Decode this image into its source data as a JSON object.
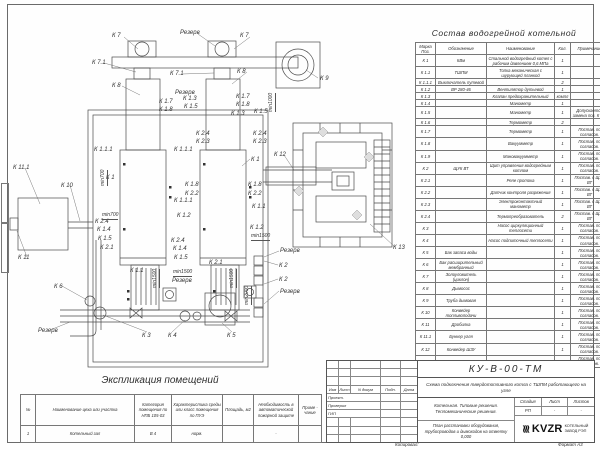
{
  "spec_table": {
    "title": "Состав водогрейной котельной",
    "headers": [
      "Марка Поз.",
      "Обозначение",
      "Наименование",
      "Кол.",
      "Примечание"
    ],
    "rows": [
      {
        "pos": "К 1",
        "designation": "КВм",
        "name": "Стальной водогрейный котел с рабочим давлением 0,6 МПа",
        "qty": "1",
        "note": ""
      },
      {
        "pos": "К 1.1",
        "designation": "ТШПМ",
        "name": "Топка механическая с шурующей планкой",
        "qty": "1",
        "note": ""
      },
      {
        "pos": "К 1.1.1",
        "designation": "Выключатель путевой",
        "name": "",
        "qty": "2",
        "note": ""
      },
      {
        "pos": "К 1.2",
        "designation": "ВР 280-46",
        "name": "Вентилятор дутьевой",
        "qty": "1",
        "note": ""
      },
      {
        "pos": "К 1.3",
        "designation": "",
        "name": "Клапан предохранительный",
        "qty": "компл",
        "note": ""
      },
      {
        "pos": "К 1.4",
        "designation": "",
        "name": "Манометр",
        "qty": "1",
        "note": ""
      },
      {
        "pos": "К 1.5",
        "designation": "",
        "name": "Манометр",
        "qty": "1",
        "note": "Допускается замена поз. К 2.3"
      },
      {
        "pos": "К 1.6",
        "designation": "",
        "name": "Термометр",
        "qty": "2",
        "note": ""
      },
      {
        "pos": "К 1.7",
        "designation": "",
        "name": "Термометр",
        "qty": "1",
        "note": "Постав. по согласов."
      },
      {
        "pos": "К 1.8",
        "designation": "",
        "name": "Вакуумметр",
        "qty": "1",
        "note": "Постав. по согласов."
      },
      {
        "pos": "К 1.9",
        "designation": "",
        "name": "Мановакуумметр",
        "qty": "1",
        "note": "Постав. по согласов."
      },
      {
        "pos": "К 2",
        "designation": "ЩУК ВТ",
        "name": "Щит управления водогрейным котлом",
        "qty": "1",
        "note": "Постав. по согласов."
      },
      {
        "pos": "К 2.1",
        "designation": "",
        "name": "Реле протока",
        "qty": "1",
        "note": "Постав. с ЩУК ВТ"
      },
      {
        "pos": "К 2.2",
        "designation": "",
        "name": "Датчик контроля разряжения",
        "qty": "1",
        "note": "Постав. с ЩУК ВТ"
      },
      {
        "pos": "К 2.3",
        "designation": "",
        "name": "Электроконтактный манометр",
        "qty": "1",
        "note": "Постав. с ЩУК ВТ"
      },
      {
        "pos": "К 2.4",
        "designation": "",
        "name": "Термопреобразователь",
        "qty": "2",
        "note": "Постав. с ЩУК ВТ"
      },
      {
        "pos": "К 3",
        "designation": "",
        "name": "Насос циркуляционный теплосети",
        "qty": "1",
        "note": "Постав. по согласов."
      },
      {
        "pos": "К 4",
        "designation": "",
        "name": "Насос подпиточный теплосети",
        "qty": "1",
        "note": "Постав. по согласов."
      },
      {
        "pos": "К 5",
        "designation": "Бак запаса воды",
        "name": "",
        "qty": "1",
        "note": "Постав. по согласов."
      },
      {
        "pos": "К 6",
        "designation": "Бак расширительный мембранный",
        "name": "",
        "qty": "1",
        "note": "Постав. по согласов."
      },
      {
        "pos": "К 7",
        "designation": "Золоуловитель (циклон)",
        "name": "",
        "qty": "1",
        "note": "Постав. по согласов."
      },
      {
        "pos": "К 8",
        "designation": "Дымосос",
        "name": "",
        "qty": "1",
        "note": "Постав. по согласов."
      },
      {
        "pos": "К 9",
        "designation": "Труба дымовая",
        "name": "",
        "qty": "1",
        "note": "Постав. по согласов."
      },
      {
        "pos": "К 10",
        "designation": "Конвейер топливоподачи",
        "name": "",
        "qty": "1",
        "note": "Постав. по согласов."
      },
      {
        "pos": "К 11",
        "designation": "Дробилка",
        "name": "",
        "qty": "1",
        "note": "Постав. по согласов."
      },
      {
        "pos": "К 11.1",
        "designation": "Бункер угля",
        "name": "",
        "qty": "1",
        "note": "Постав. по согласов."
      },
      {
        "pos": "К 12",
        "designation": "Конвейер ШЗУ",
        "name": "",
        "qty": "1",
        "note": "Постав. по согласов."
      },
      {
        "pos": "К 13",
        "designation": "Бункер шлакоприемник",
        "name": "",
        "qty": "1",
        "note": "Постав. по согласов."
      }
    ]
  },
  "expl_table": {
    "title": "Экспликация помещений",
    "headers": [
      "№",
      "Наименование цеха или участка",
      "Категория помещения по НПБ 105-03",
      "Характеристика среды или класс помещения по ПУЭ",
      "Площадь, м2",
      "Необходимость в автоматической пожарной защите",
      "Приме - чание"
    ],
    "rows": [
      [
        "1",
        "Котельный зал",
        "В 4",
        "норм.",
        "",
        "-",
        ""
      ]
    ]
  },
  "stamp": {
    "doc_number": "КУ-В-00-ТМ",
    "scheme_title": "Схема подключения твердотопливного котла с ТШПМ работающего на угле",
    "object_title": "Котельная. Типовые решения. Тепломеханические решения.",
    "plan_title": "План расстановки оборудования, трубопроводов и дымоходов на отметку 0,000",
    "stage_labels": [
      "Стадия",
      "Лист",
      "Листов"
    ],
    "stage_values": [
      "РП",
      "-",
      "-"
    ],
    "header_cols": [
      "Изм",
      "Лист",
      "N докум",
      "Подп.",
      "Дата"
    ],
    "role_rows": [
      "Проект.",
      "Проверил",
      "ГИП"
    ],
    "logo_glyph": "≋",
    "logo_text": "KVZR",
    "company_line1": "КОТЕЛЬНЫЙ",
    "company_line2": "ЗАВОД РЭП",
    "copied_label": "Копировал:",
    "format_label": "Формат А3"
  },
  "drawing": {
    "line_color": "#4a4a4a",
    "labels": [
      [
        "К 7",
        112,
        33
      ],
      [
        "Резерв",
        180,
        30
      ],
      [
        "К 7",
        240,
        33
      ],
      [
        "К 7.1",
        92,
        60
      ],
      [
        "К 8",
        112,
        83
      ],
      [
        "К 7.1",
        170,
        71
      ],
      [
        "К 8",
        237,
        69
      ],
      [
        "К 9",
        320,
        76
      ],
      [
        "Резерв",
        175,
        90
      ],
      [
        "К 1.7",
        159,
        99
      ],
      [
        "К 1.8",
        159,
        107
      ],
      [
        "К 1.3",
        183,
        96
      ],
      [
        "К 1.5",
        184,
        104
      ],
      [
        "К 1.7",
        236,
        94
      ],
      [
        "К 1.8",
        236,
        102
      ],
      [
        "К 1.3",
        231,
        111
      ],
      [
        "К 1.5",
        254,
        109
      ],
      [
        "К 2.4",
        196,
        131
      ],
      [
        "К 2.3",
        196,
        139
      ],
      [
        "К 2.4",
        253,
        131
      ],
      [
        "К 2.3",
        253,
        139
      ],
      [
        "К 1.1.1",
        94,
        147
      ],
      [
        "К 1.1.1",
        174,
        147
      ],
      [
        "К 1",
        106,
        175
      ],
      [
        "К 1",
        251,
        157
      ],
      [
        "К 1.8",
        185,
        182
      ],
      [
        "К 2.2",
        185,
        191
      ],
      [
        "К 1.8",
        248,
        182
      ],
      [
        "К 2.2",
        248,
        191
      ],
      [
        "К 1.1.1",
        174,
        198
      ],
      [
        "К 1.1",
        252,
        204
      ],
      [
        "К 1.2",
        177,
        213
      ],
      [
        "К 1.2",
        250,
        225
      ],
      [
        "К 2.4",
        95,
        219
      ],
      [
        "К 1.4",
        97,
        227
      ],
      [
        "К 1.5",
        98,
        236
      ],
      [
        "К 2.1",
        100,
        245
      ],
      [
        "К 2.4",
        171,
        238
      ],
      [
        "К 1.4",
        173,
        246
      ],
      [
        "К 1.5",
        174,
        255
      ],
      [
        "К 2.1",
        209,
        260
      ],
      [
        "К 1.1",
        130,
        268
      ],
      [
        "Резерв",
        172,
        278
      ],
      [
        "Резерв",
        280,
        248
      ],
      [
        "К 2",
        279,
        263
      ],
      [
        "К 2",
        279,
        277
      ],
      [
        "Резерв",
        280,
        289
      ],
      [
        "К 3",
        142,
        333
      ],
      [
        "К 4",
        168,
        333
      ],
      [
        "К 5",
        227,
        333
      ],
      [
        "К 11.1",
        13,
        165
      ],
      [
        "К 10",
        61,
        183
      ],
      [
        "К 11",
        18,
        255
      ],
      [
        "К 6",
        54,
        284
      ],
      [
        "Резерв",
        38,
        328
      ],
      [
        "К 12",
        274,
        152
      ],
      [
        "К 13",
        393,
        245
      ]
    ],
    "dims": [
      [
        "min700",
        100,
        186,
        1
      ],
      [
        "min700",
        102,
        212,
        0
      ],
      [
        "min1000",
        268,
        112,
        1
      ],
      [
        "min1500",
        152,
        288,
        1
      ],
      [
        "min1500",
        173,
        269,
        0
      ],
      [
        "min1500",
        229,
        288,
        1
      ],
      [
        "min1500",
        251,
        233,
        0
      ],
      [
        "min2000",
        244,
        305,
        1
      ]
    ]
  }
}
